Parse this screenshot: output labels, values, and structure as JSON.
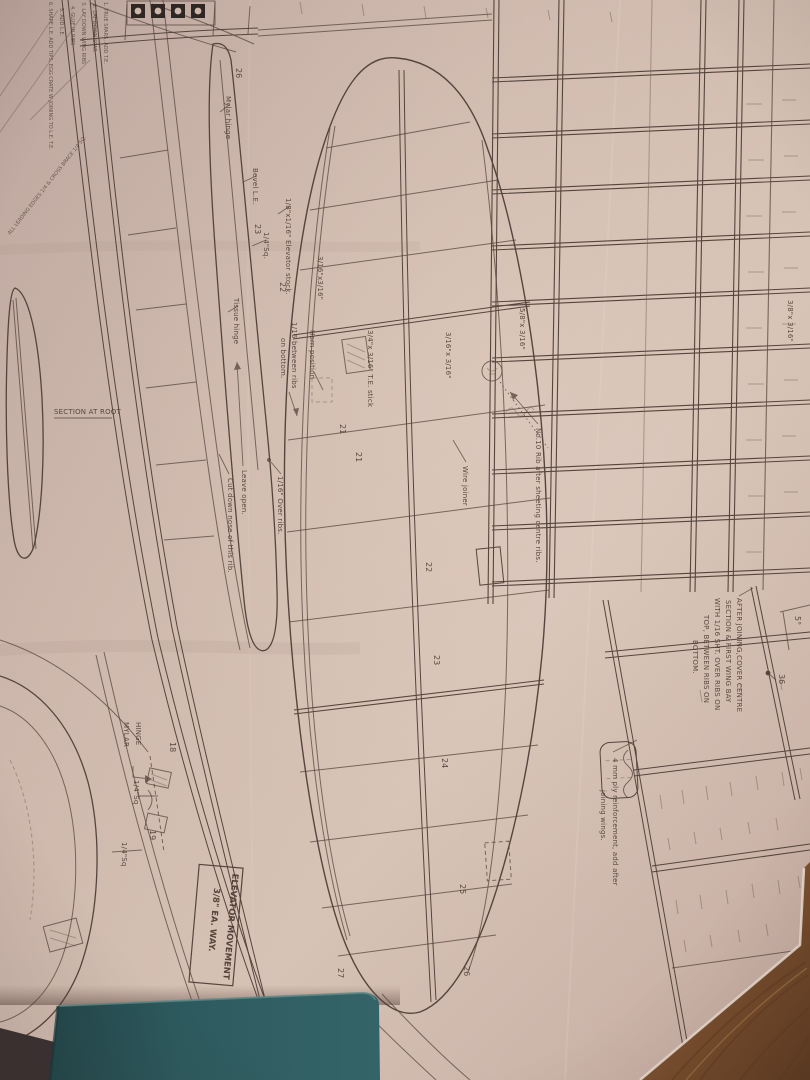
{
  "photo": {
    "paper_color": "#c9b2a8",
    "paper_light": "#dcc7bb",
    "paper_shadow": "#ac938a",
    "line_color": "#55453d",
    "book_color": "#2d5a5e",
    "wood_color": "#7a4f2e",
    "dark_corner_color": "#3a3132"
  },
  "plan": {
    "build_steps": {
      "lines": [
        "1. TRUE SPARS, ADD T.E.",
        "2. LAY DOWN SPAR",
        "3. LAY DOWN WING RIBS",
        "4. GLUE IN RIBS",
        "5. ADD L.E.",
        "6. SHAPE L.E. ADD TIPS, EGG CRATE W JOINING TO L.E. T.E."
      ]
    },
    "notes": {
      "after_joining": {
        "lines": [
          "AFTER JOINING,COVER CENTRE",
          "SECTION & FIRST WING BAY",
          "WITH 1/16 SHT. OVER RIBS ON",
          "TOP, BETWEEN RIBS ON",
          "BOTTOM."
        ]
      },
      "ply_reinforcement": {
        "lines": [
          "4 mm ply reinforcement, add after",
          "joining wings."
        ]
      },
      "leading_edges": "ALL LEADING EDGES 1/4 & CROSS BRACE 1/4 SQ.",
      "rib10": "No.10 Rib after sheeting centre ribs.",
      "elevator_movement": {
        "lines": [
          "ELEVATOR MOVEMENT",
          "3/8\" EA. WAY."
        ]
      },
      "section_at_root": "SECTION AT ROOT"
    },
    "callouts": {
      "wire_joiner": "Wire joiner",
      "over_ribs": "1/16\" Over ribs.",
      "leave_open": "Leave open.",
      "cut_down_nose": "Cut down nose of this rib.",
      "between_ribs_1": "1/16 between ribs",
      "between_ribs_2": "on bottom.",
      "horn_position": "Horn  position",
      "elevator_stock": "1/8\"x1/16\" Elevator stock.",
      "bevel_le": "Bevel L.E.",
      "quarter_sq_small": "1/4\"Sq.",
      "mylar_hinge_small": "Mylar hinge",
      "tissue_hinge": "Tissue hinge",
      "mylar_caps_1": "MYLAR",
      "mylar_caps_2": "HINGE",
      "quarter_sq_a": "1/4\"Sq",
      "quarter_sq_b": "1/4\"Sq",
      "dihedral_angle": "5°"
    },
    "stock_sizes": {
      "s316_a": "3/16\"x3/16\"",
      "te_stick": "3/4\"x 3/16\" T.E. stick",
      "s316_b": "3/16\"x 3/16\"",
      "s58": "5/8\"x 3/16\"",
      "s38_top": "3/8\"x 3/16\"",
      "s38_right": "3/8\" 3/16\""
    },
    "rib_numbers": {
      "n18": "18",
      "n19": "19",
      "n21a": "21",
      "n21b": "21",
      "n22": "22",
      "n23": "23",
      "n24": "24",
      "n25": "25",
      "n26": "26",
      "n27": "27",
      "n36": "36",
      "e26": "26",
      "e23": "23",
      "e22": "22"
    }
  }
}
